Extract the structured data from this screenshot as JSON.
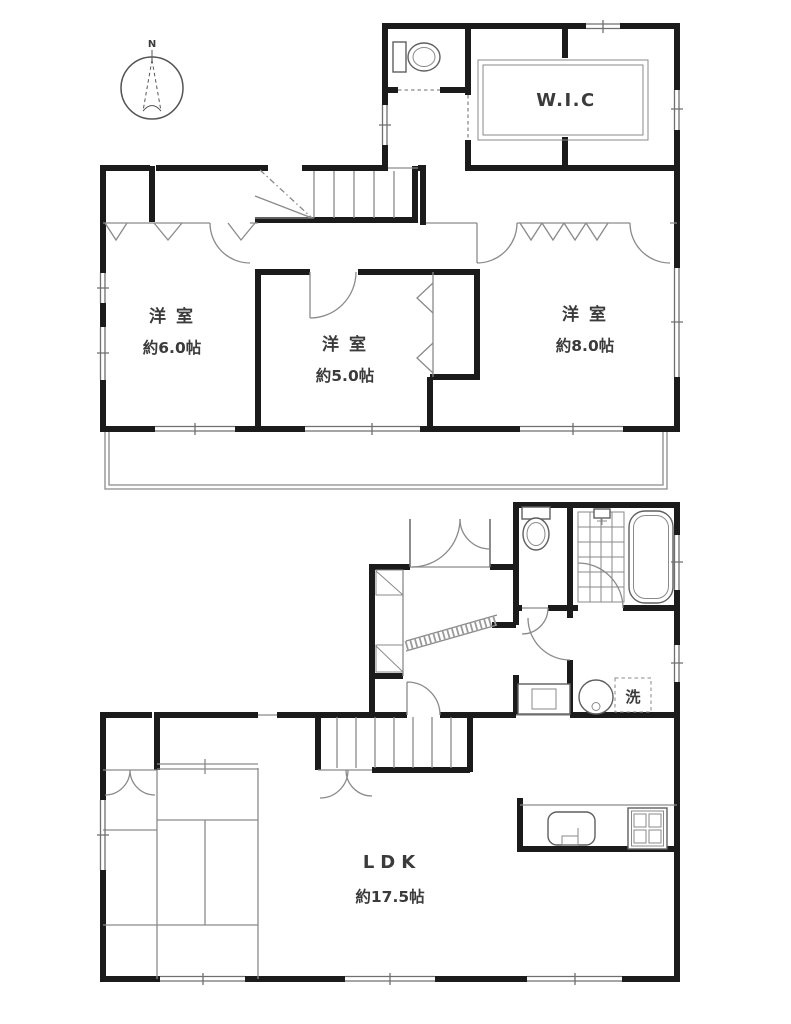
{
  "compass": {
    "north_label": "N"
  },
  "colors": {
    "wall": "#1b1b1b",
    "thin_line": "#8a8a8a",
    "label": "#3b3b3b",
    "background": "#ffffff"
  },
  "floor_2f": {
    "wic_label": "W.I.C",
    "rooms": [
      {
        "name": "洋 室",
        "size": "約6.0帖"
      },
      {
        "name": "洋 室",
        "size": "約5.0帖"
      },
      {
        "name": "洋 室",
        "size": "約8.0帖"
      }
    ]
  },
  "floor_1f": {
    "ldk": {
      "name": "LDK",
      "size": "約17.5帖"
    },
    "laundry_label": "洗"
  },
  "icons": {
    "compass_icon": "north-arrow",
    "toilet_icon": "toilet",
    "bathtub_icon": "bathtub",
    "shower_icon": "shower-faucet",
    "sink_icon": "kitchen-sink",
    "stove_icon": "gas-stove",
    "washer_icon": "washing-machine-pan",
    "vanity_icon": "wash-basin-counter",
    "shoe_cabinet_icon": "shoe-cabinet",
    "stairs_icon": "staircase",
    "tatami_icon": "tatami-mats",
    "balcony_icon": "balcony"
  }
}
